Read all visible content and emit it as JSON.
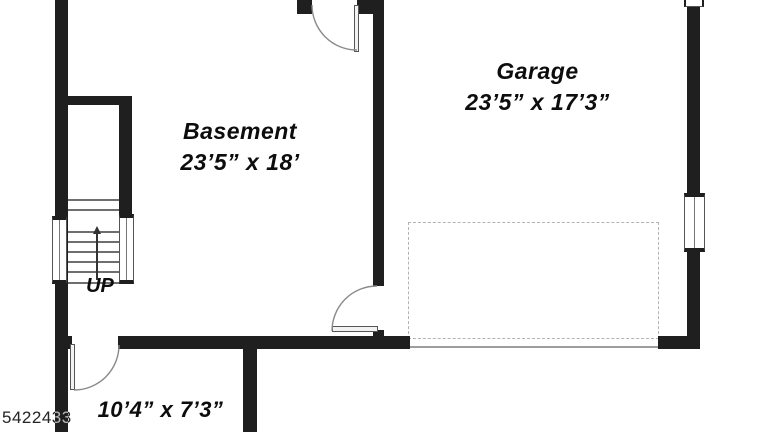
{
  "plan": {
    "watermark": "5422433",
    "rooms": [
      {
        "name": "Basement",
        "dims": "23’5” x 18’"
      },
      {
        "name": "Garage",
        "dims": "23’5” x 17’3”"
      },
      {
        "name": "",
        "dims": "10’4” x 7’3”"
      }
    ],
    "stairs_label": "UP",
    "colors": {
      "wall": "#1f1f1f",
      "line": "#8a8a8a",
      "dash": "#b3b3b3",
      "ink": "#0d0d0d",
      "watermark": "#d9d9d9"
    }
  }
}
